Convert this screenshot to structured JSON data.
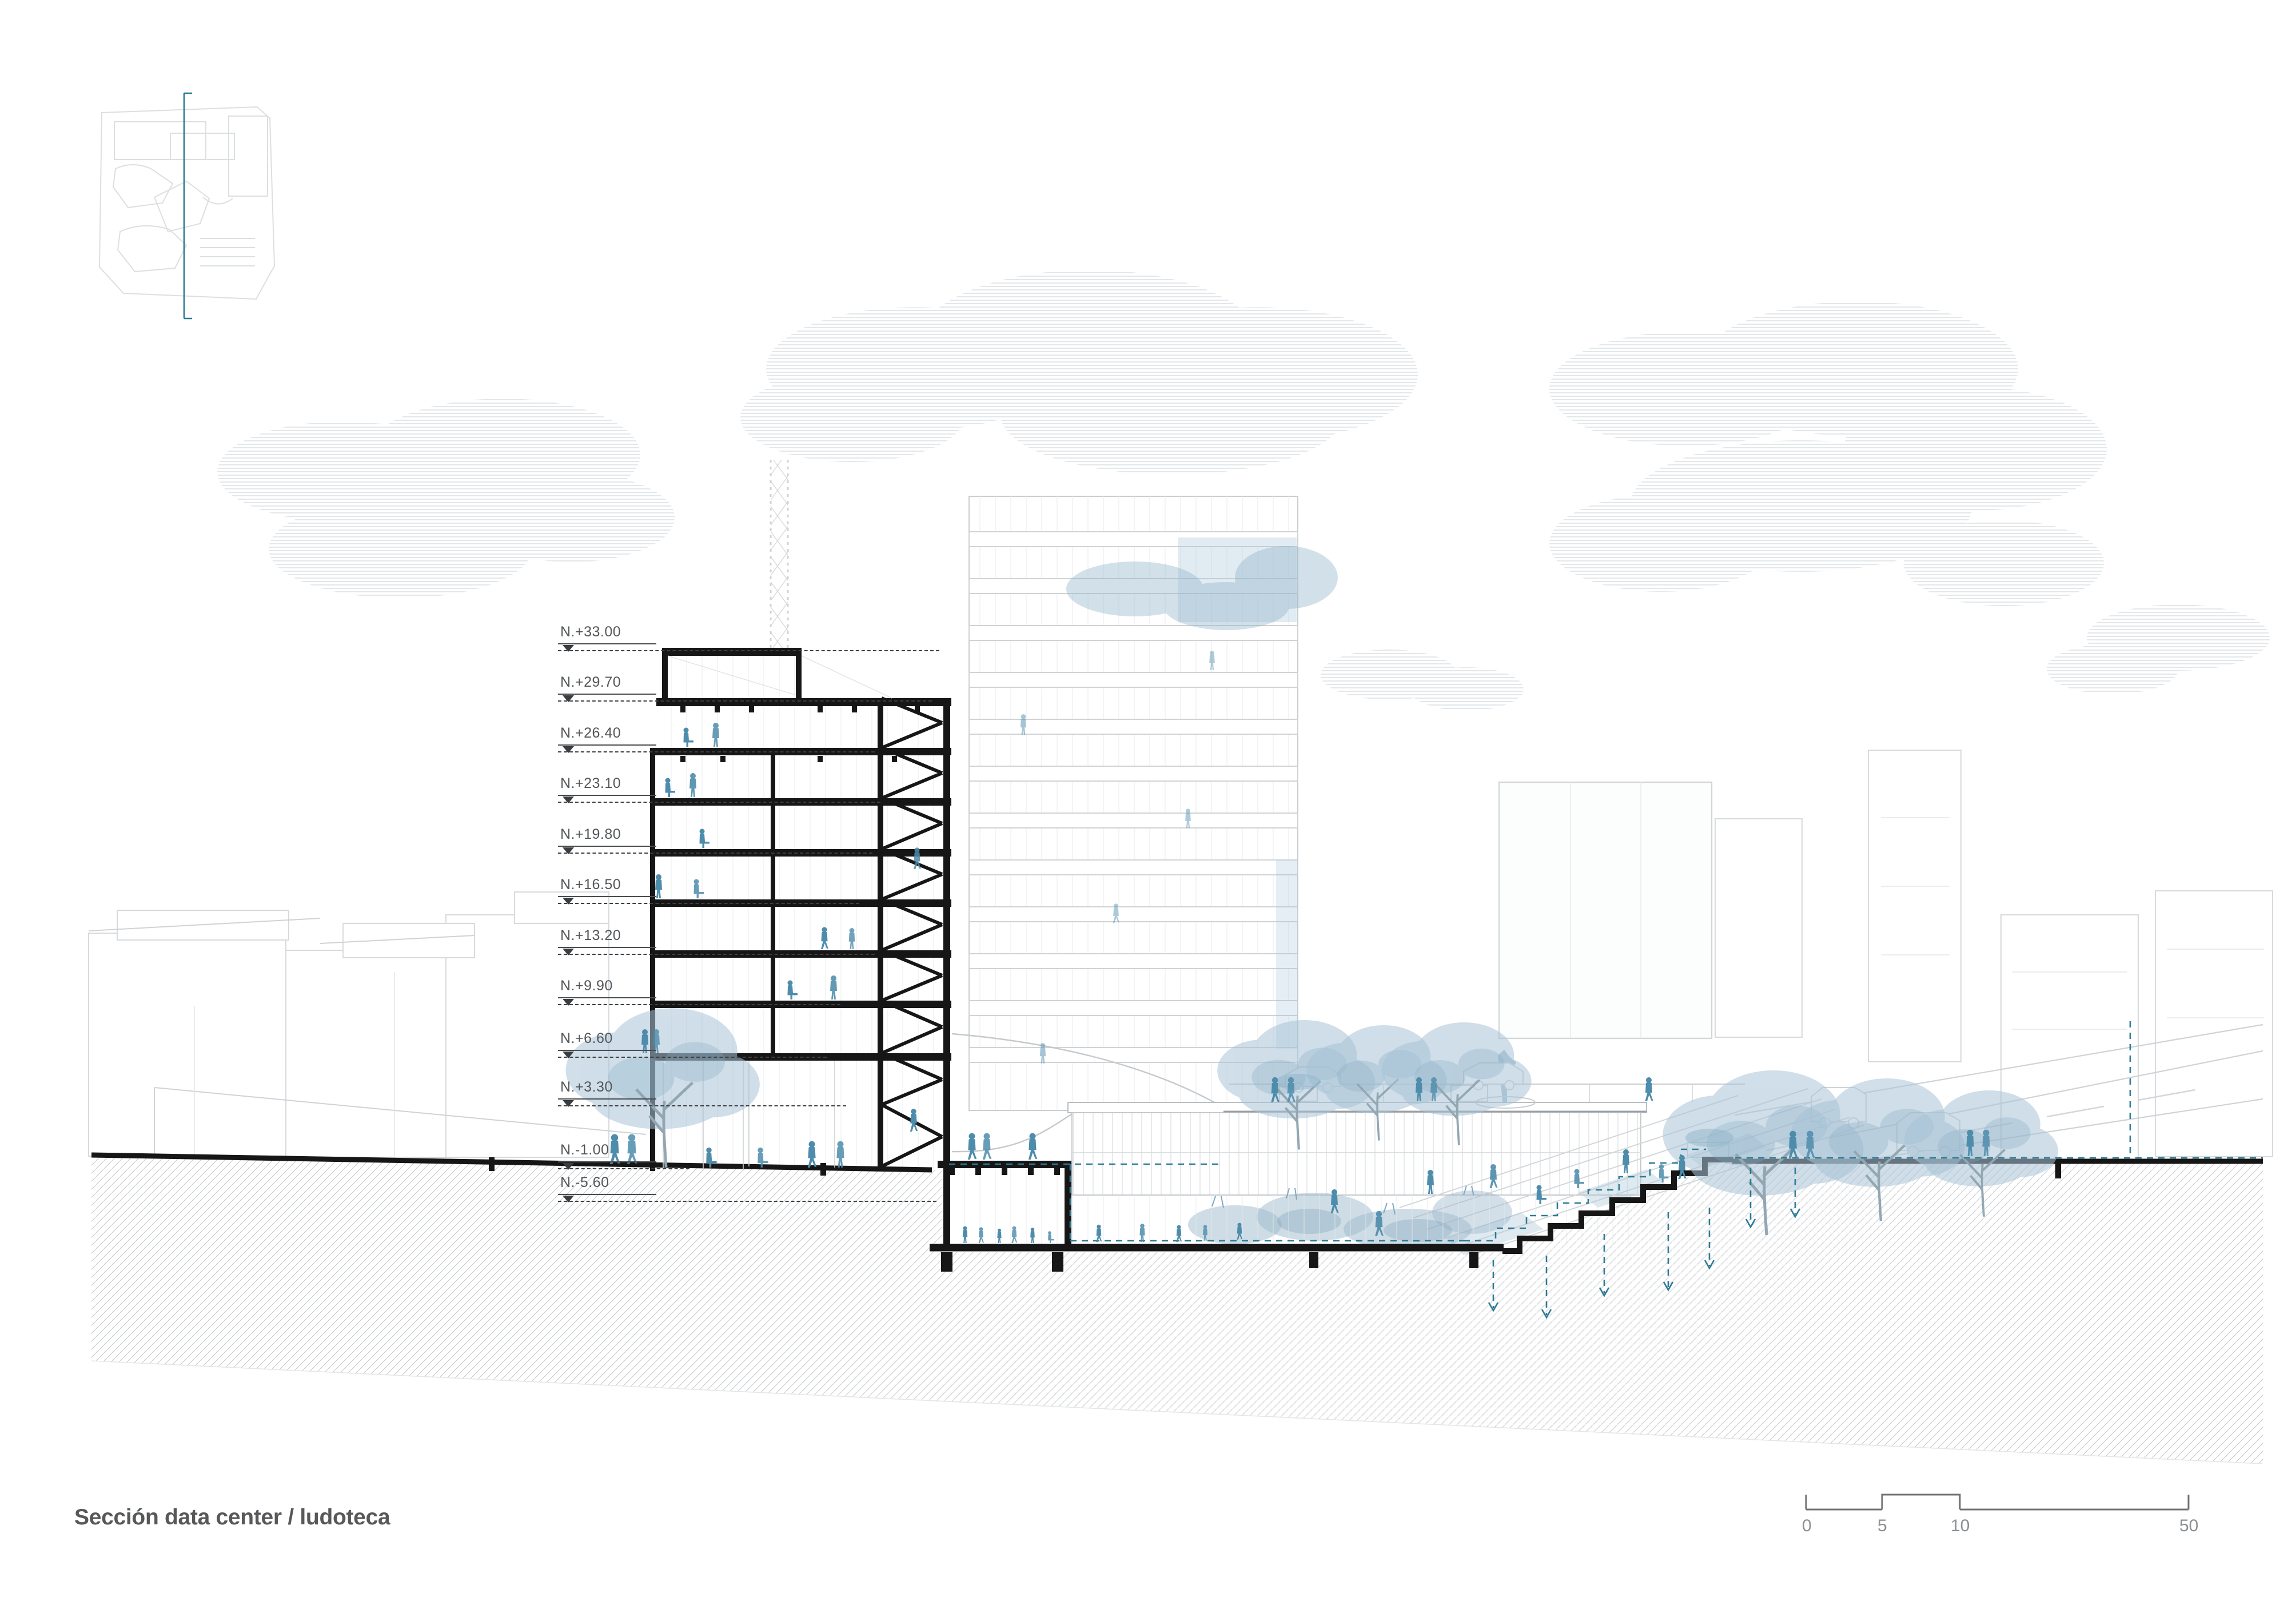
{
  "page": {
    "title": "Sección data center / ludoteca"
  },
  "levels": [
    {
      "label": "N.+33.00"
    },
    {
      "label": "N.+29.70"
    },
    {
      "label": "N.+26.40"
    },
    {
      "label": "N.+23.10"
    },
    {
      "label": "N.+19.80"
    },
    {
      "label": "N.+16.50"
    },
    {
      "label": "N.+13.20"
    },
    {
      "label": "N.+9.90"
    },
    {
      "label": "N.+6.60"
    },
    {
      "label": "N.+3.30"
    },
    {
      "label": "N.-1.00"
    },
    {
      "label": "N.-5.60"
    }
  ],
  "scalebar": {
    "ticks": [
      "0",
      "5",
      "10",
      "50"
    ]
  },
  "legend_colors": {
    "section_cut_black": "#161616",
    "annotation_gray": "#3c3f42",
    "teal_accent": "#2c7a94",
    "people_blue": "#4e8cab",
    "foliage_blue": "#a9c4d7",
    "faint_line_gray": "#d5d9db",
    "hatch_gray": "#c6cacd",
    "cloud_stripe": "#e3e7ea",
    "title_gray": "#57585a"
  }
}
